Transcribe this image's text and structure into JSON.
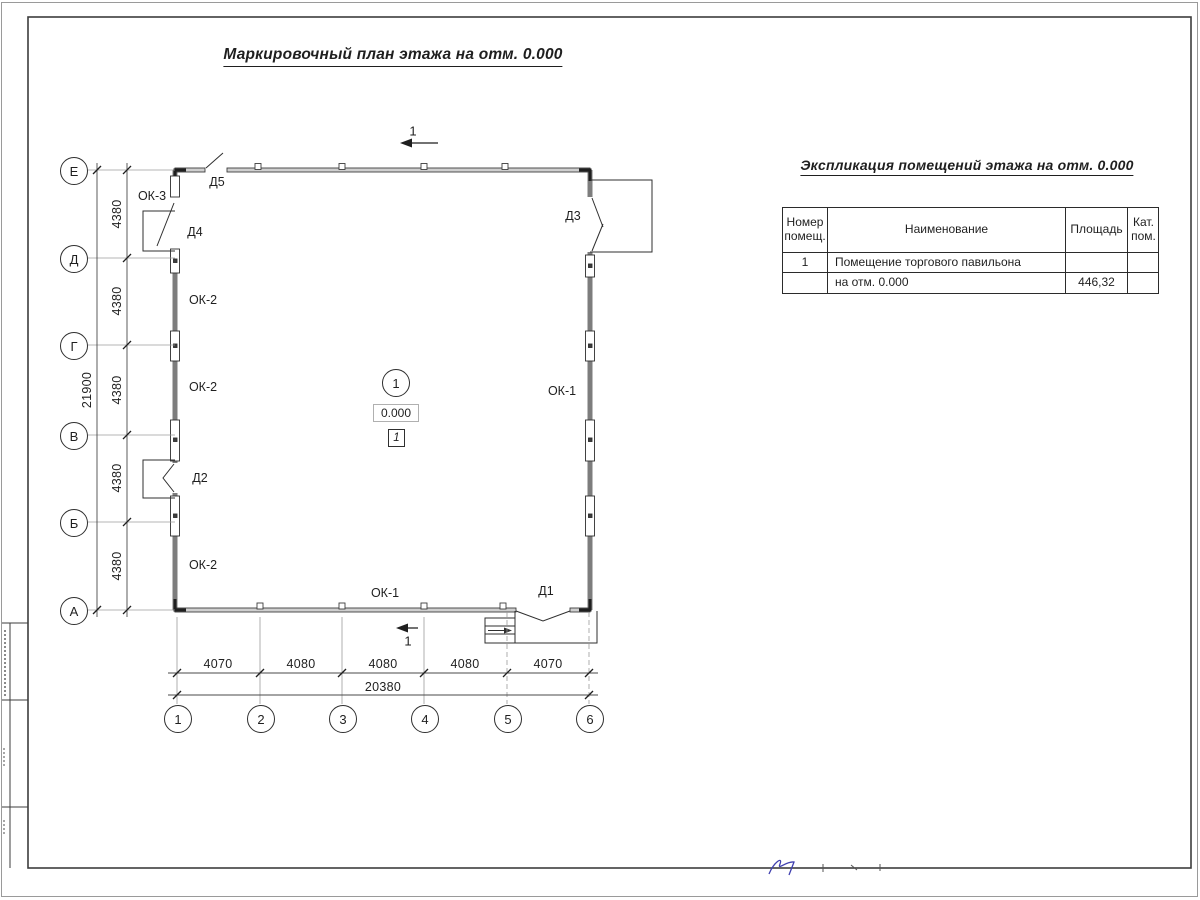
{
  "drawing_title": "Маркировочный план этажа на отм. 0.000",
  "plan": {
    "row_axes": [
      "Е",
      "Д",
      "Г",
      "В",
      "Б",
      "А"
    ],
    "col_axes": [
      "1",
      "2",
      "3",
      "4",
      "5",
      "6"
    ],
    "left_dim_segments": [
      "4380",
      "4380",
      "4380",
      "4380",
      "4380"
    ],
    "left_dim_total": "21900",
    "bottom_dim_segments": [
      "4070",
      "4080",
      "4080",
      "4080",
      "4070"
    ],
    "bottom_dim_total": "20380",
    "window_labels": {
      "ok1": "ОК-1",
      "ok2": "ОК-2",
      "ok3": "ОК-3"
    },
    "door_labels": {
      "d1": "Д1",
      "d2": "Д2",
      "d3": "Д3",
      "d4": "Д4",
      "d5": "Д5"
    },
    "room": {
      "number": "1",
      "elevation": "0.000",
      "marker": "1"
    },
    "section_mark_label": "1"
  },
  "table": {
    "title": "Экспликация помещений этажа на отм. 0.000",
    "col_headers": [
      "Номер\nпомещ.",
      "Наименование",
      "Площадь",
      "Кат.\nпом."
    ],
    "rows": [
      {
        "num": "1",
        "name": "Помещение торгового павильона",
        "area": "",
        "cat": ""
      },
      {
        "num": "",
        "name": "на отм. 0.000",
        "area": "446,32",
        "cat": ""
      }
    ]
  },
  "colors": {
    "wall_gray": "#7d7d7d",
    "line_dark": "#2f2f2f",
    "annotation_blue": "#4040b0"
  }
}
